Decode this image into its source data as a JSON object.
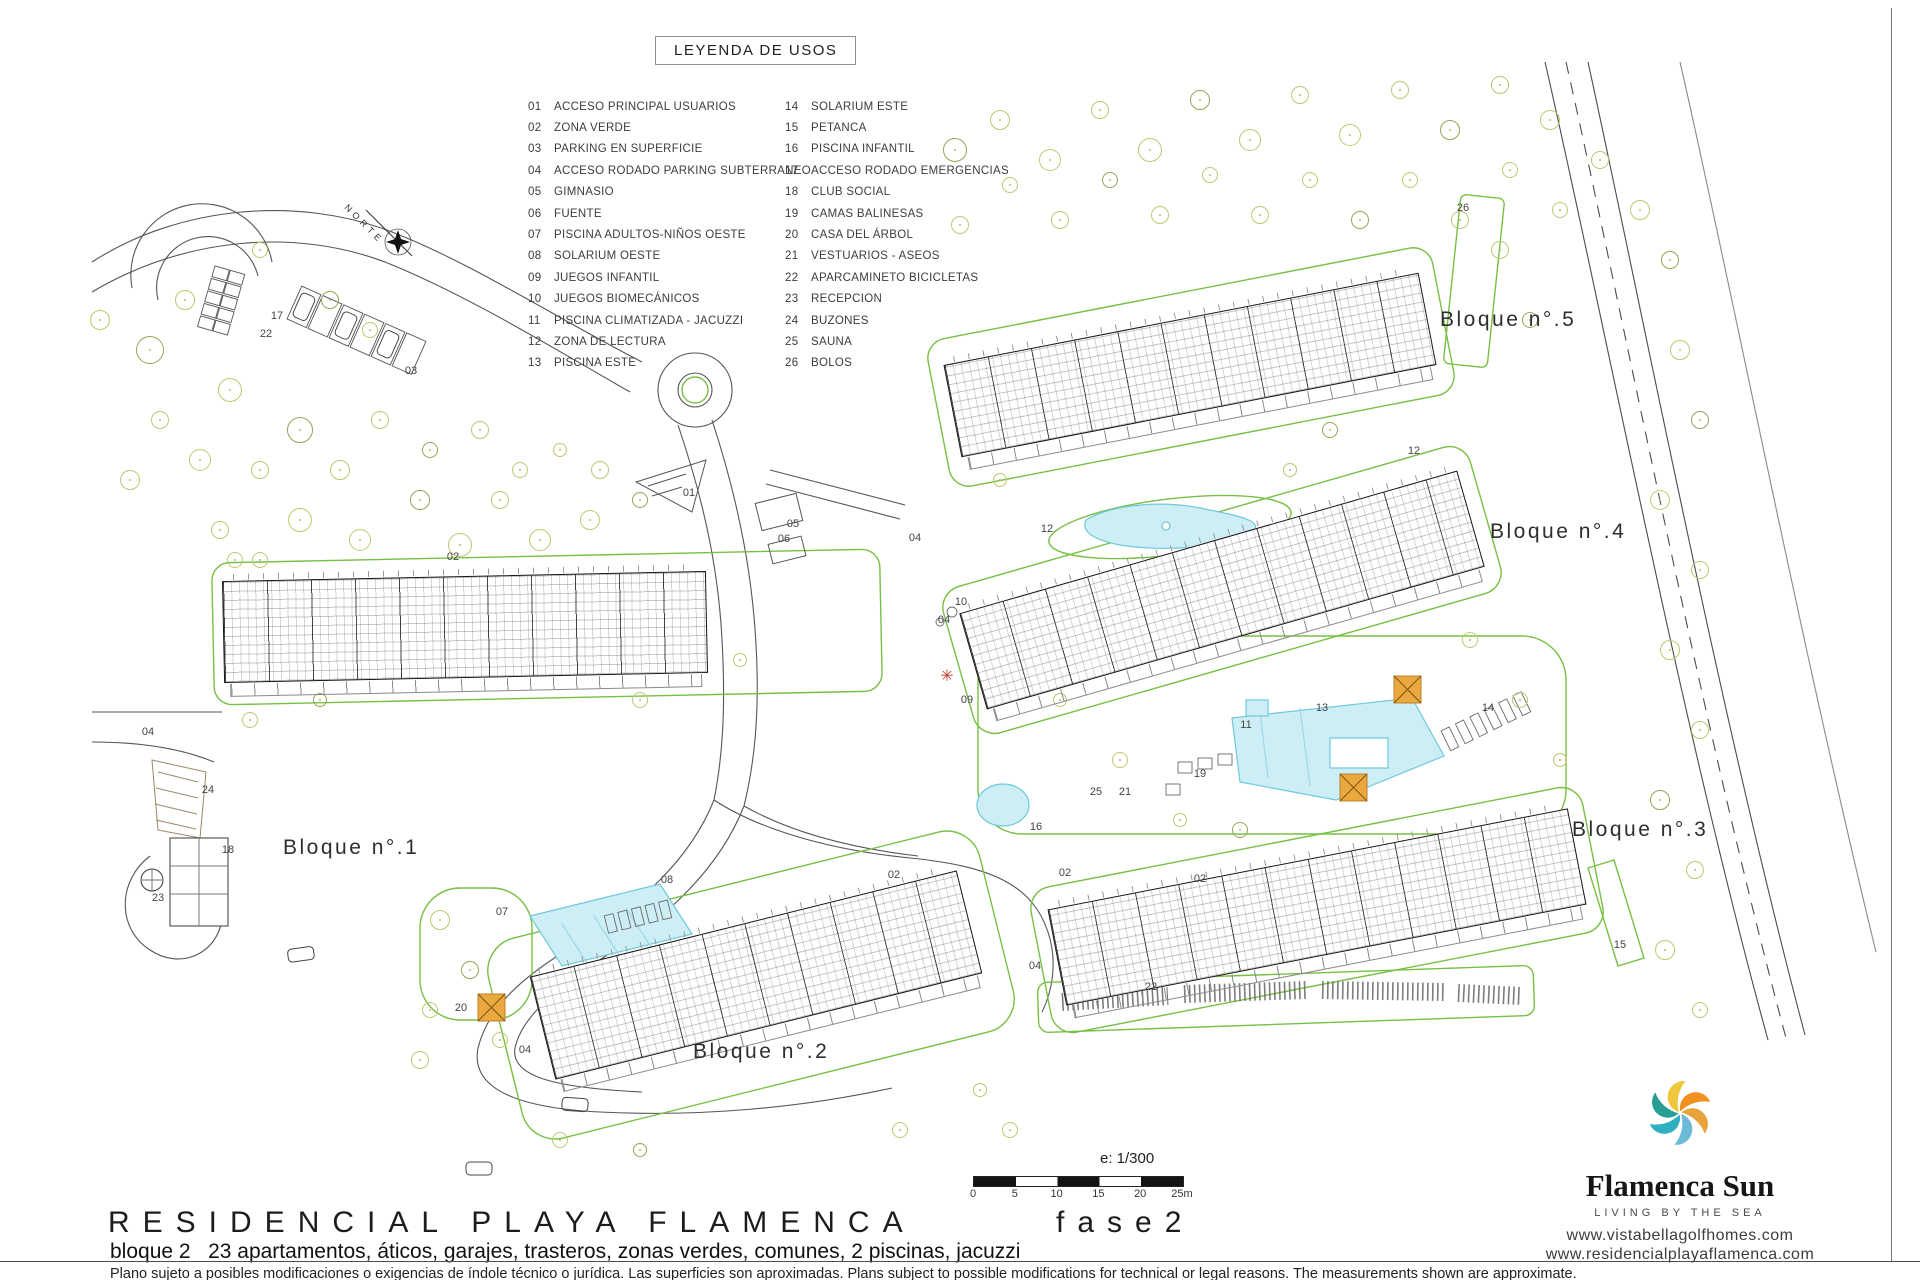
{
  "legend": {
    "title": "LEYENDA DE USOS",
    "items_left": [
      {
        "num": "01",
        "label": "ACCESO PRINCIPAL USUARIOS"
      },
      {
        "num": "02",
        "label": "ZONA VERDE"
      },
      {
        "num": "03",
        "label": "PARKING EN SUPERFICIE"
      },
      {
        "num": "04",
        "label": "ACCESO RODADO PARKING SUBTERRANEO"
      },
      {
        "num": "05",
        "label": "GIMNASIO"
      },
      {
        "num": "06",
        "label": "FUENTE"
      },
      {
        "num": "07",
        "label": "PISCINA ADULTOS-NIÑOS OESTE"
      },
      {
        "num": "08",
        "label": "SOLARIUM OESTE"
      },
      {
        "num": "09",
        "label": "JUEGOS INFANTIL"
      },
      {
        "num": "10",
        "label": "JUEGOS BIOMECÁNICOS"
      },
      {
        "num": "11",
        "label": "PISCINA CLIMATIZADA - JACUZZI"
      },
      {
        "num": "12",
        "label": "ZONA DE LECTURA"
      },
      {
        "num": "13",
        "label": "PISCINA ESTE"
      }
    ],
    "items_right": [
      {
        "num": "14",
        "label": "SOLARIUM ESTE"
      },
      {
        "num": "15",
        "label": "PETANCA"
      },
      {
        "num": "16",
        "label": "PISCINA INFANTIL"
      },
      {
        "num": "17",
        "label": "ACCESO RODADO EMERGENCIAS"
      },
      {
        "num": "18",
        "label": "CLUB SOCIAL"
      },
      {
        "num": "19",
        "label": "CAMAS BALINESAS"
      },
      {
        "num": "20",
        "label": "CASA DEL ÁRBOL"
      },
      {
        "num": "21",
        "label": "VESTUARIOS - ASEOS"
      },
      {
        "num": "22",
        "label": "APARCAMINETO BICICLETAS"
      },
      {
        "num": "23",
        "label": "RECEPCION"
      },
      {
        "num": "24",
        "label": "BUZONES"
      },
      {
        "num": "25",
        "label": "SAUNA"
      },
      {
        "num": "26",
        "label": "BOLOS"
      }
    ]
  },
  "plan": {
    "north_label": "NORTE",
    "block_labels": [
      {
        "label": "Bloque n°.1",
        "x": 283,
        "y": 836
      },
      {
        "label": "Bloque n°.2",
        "x": 693,
        "y": 1040
      },
      {
        "label": "Bloque n°.3",
        "x": 1572,
        "y": 818
      },
      {
        "label": "Bloque n°.4",
        "x": 1490,
        "y": 520
      },
      {
        "label": "Bloque n°.5",
        "x": 1440,
        "y": 308
      }
    ],
    "area_labels": [
      {
        "n": "17",
        "x": 277,
        "y": 316
      },
      {
        "n": "22",
        "x": 266,
        "y": 334
      },
      {
        "n": "03",
        "x": 411,
        "y": 371
      },
      {
        "n": "02",
        "x": 453,
        "y": 557
      },
      {
        "n": "01",
        "x": 689,
        "y": 493
      },
      {
        "n": "05",
        "x": 793,
        "y": 524
      },
      {
        "n": "06",
        "x": 784,
        "y": 539
      },
      {
        "n": "04",
        "x": 148,
        "y": 732
      },
      {
        "n": "04",
        "x": 915,
        "y": 538
      },
      {
        "n": "04",
        "x": 944,
        "y": 620
      },
      {
        "n": "04",
        "x": 525,
        "y": 1050
      },
      {
        "n": "04",
        "x": 1035,
        "y": 966
      },
      {
        "n": "24",
        "x": 208,
        "y": 790
      },
      {
        "n": "18",
        "x": 228,
        "y": 850
      },
      {
        "n": "23",
        "x": 158,
        "y": 898
      },
      {
        "n": "08",
        "x": 667,
        "y": 880
      },
      {
        "n": "07",
        "x": 502,
        "y": 912
      },
      {
        "n": "20",
        "x": 461,
        "y": 1008
      },
      {
        "n": "02",
        "x": 894,
        "y": 875
      },
      {
        "n": "02",
        "x": 1065,
        "y": 873
      },
      {
        "n": "02",
        "x": 1200,
        "y": 879
      },
      {
        "n": "09",
        "x": 967,
        "y": 700
      },
      {
        "n": "10",
        "x": 961,
        "y": 602
      },
      {
        "n": "12",
        "x": 1047,
        "y": 529
      },
      {
        "n": "12",
        "x": 1414,
        "y": 451
      },
      {
        "n": "16",
        "x": 1036,
        "y": 827
      },
      {
        "n": "19",
        "x": 1200,
        "y": 774
      },
      {
        "n": "25",
        "x": 1096,
        "y": 792
      },
      {
        "n": "21",
        "x": 1125,
        "y": 792
      },
      {
        "n": "11",
        "x": 1246,
        "y": 725
      },
      {
        "n": "13",
        "x": 1322,
        "y": 708
      },
      {
        "n": "14",
        "x": 1488,
        "y": 708
      },
      {
        "n": "15",
        "x": 1620,
        "y": 945
      },
      {
        "n": "26",
        "x": 1463,
        "y": 208
      },
      {
        "n": "22",
        "x": 1151,
        "y": 987
      }
    ]
  },
  "scale": {
    "ratio_label": "e: 1/300",
    "ticks": [
      "0",
      "5",
      "10",
      "15",
      "20",
      "25m"
    ]
  },
  "footer": {
    "title": "RESIDENCIAL PLAYA FLAMENCA",
    "phase": "fase2",
    "subtitle": "bloque 2   23 apartamentos, áticos, garajes, trasteros, zonas verdes, comunes, 2 piscinas, jacuzzi",
    "disclaimer": "Plano sujeto a posibles modificaciones o exigencias de índole técnico o jurídica. Las superficies son aproximadas. Plans subject to possible modifications for technical or legal reasons. The measurements shown are approximate."
  },
  "brand": {
    "name": "Flamenca Sun",
    "tagline": "LIVING BY THE SEA",
    "url1": "www.vistabellagolfhomes.com",
    "url2": "www.residencialplayaflamenca.com",
    "logo_icon": "sun-swirl-icon",
    "logo_colors": [
      "#f0c63c",
      "#ef9020",
      "#e8a33b",
      "#6db9d8",
      "#2fb0c0",
      "#279d93"
    ]
  },
  "colors": {
    "green_line": "#76c043",
    "tree_line": "#c3c56f",
    "pool_fill": "#cdeef5",
    "pool_stroke": "#6fc8dc",
    "orange_square": "#eaa83e",
    "road_line": "#555555"
  }
}
